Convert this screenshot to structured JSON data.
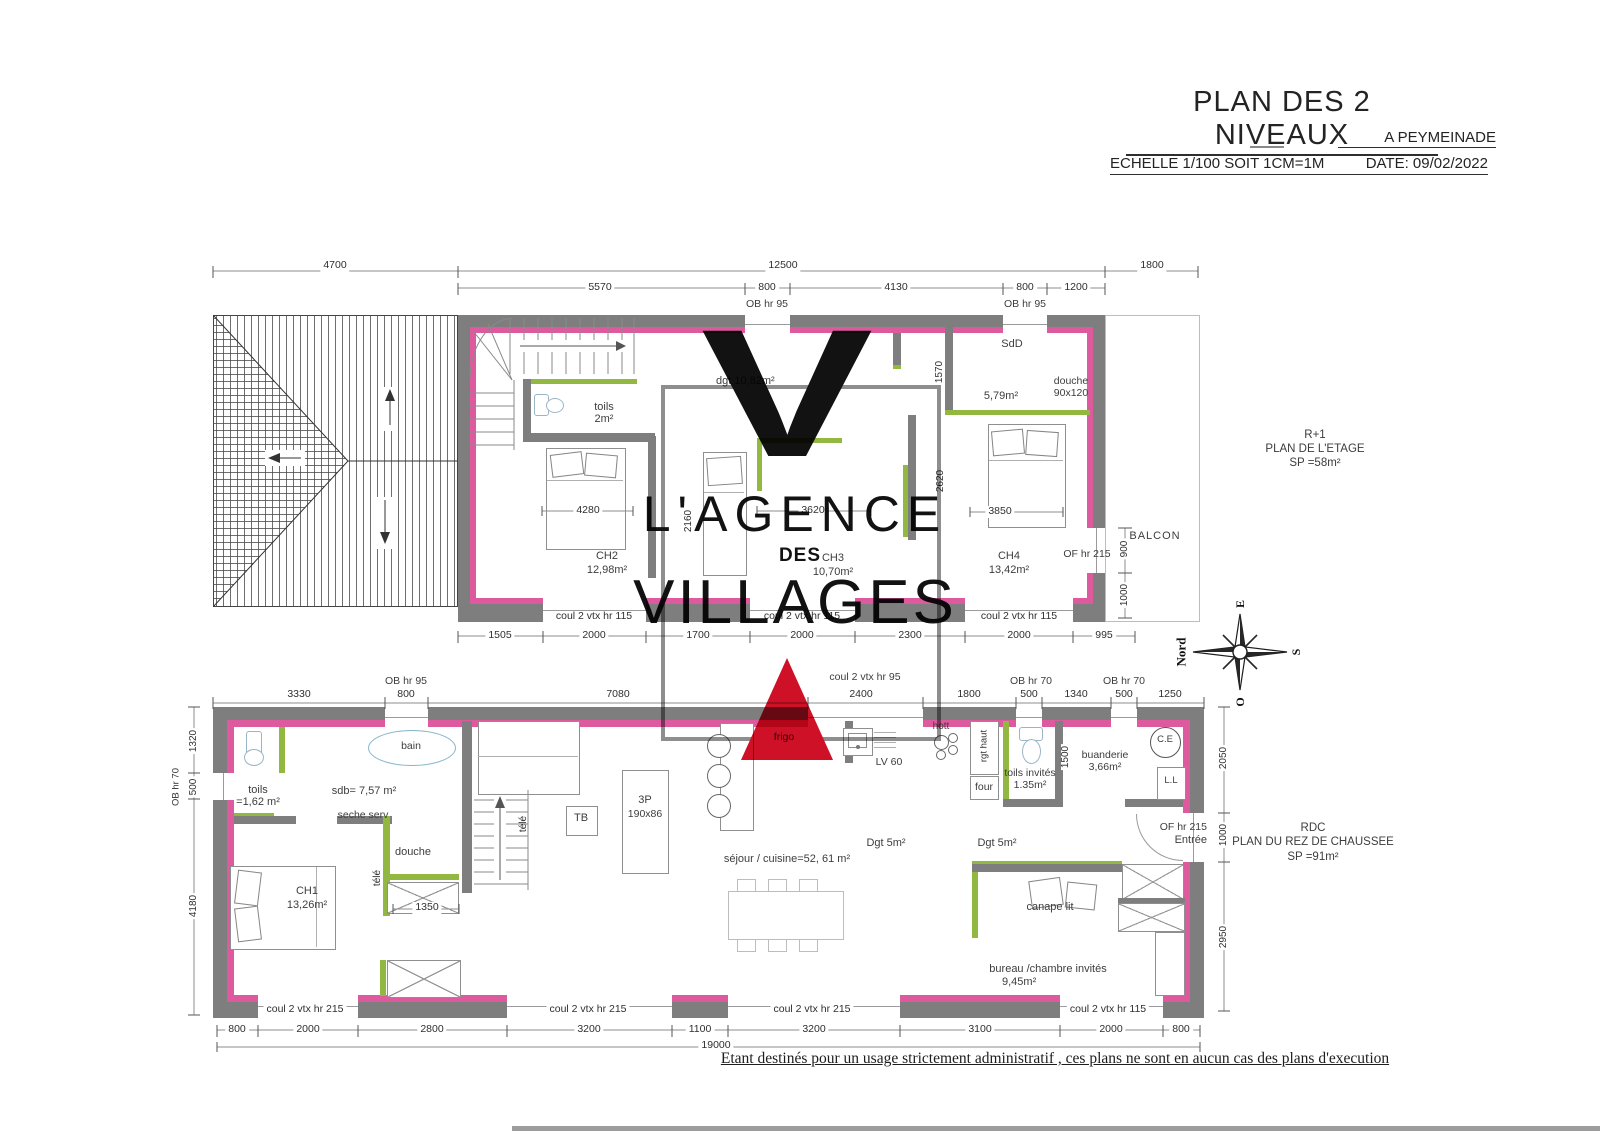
{
  "colors": {
    "wall_gray": "#7e7e7e",
    "wall_pink": "#de5a9e",
    "wall_green": "#93b841",
    "logo_red": "#ce1126",
    "logo_frame_gray": "#8e8e8e"
  },
  "title_block": {
    "title": "PLAN DES 2 NIVEAUX",
    "location": "A PEYMEINADE",
    "scale": "ECHELLE 1/100 SOIT 1CM=1M",
    "date": "DATE: 09/02/2022"
  },
  "disclaimer": "Etant destinés pour un usage strictement administratif , ces plans ne sont en aucun cas des plans d'execution",
  "watermark": {
    "v": "V",
    "l1": "L'AGENCE",
    "l2": "DES",
    "l3": "VILLAGES"
  },
  "compass": {
    "north": "Nord",
    "east": "E",
    "south": "S",
    "west": "O"
  },
  "upper": {
    "title": {
      "l1": "R+1",
      "l2": "PLAN DE L'ETAGE",
      "l3": "SP =58m²"
    },
    "dims_row1": [
      "4700",
      "12500",
      "1800"
    ],
    "dims_row2": [
      "5570",
      "800",
      "4130",
      "800",
      "1200"
    ],
    "ob_labels": [
      "OB hr 95",
      "OB hr 95"
    ],
    "window_labels": [
      "coul 2 vtx hr 115",
      "coul 2 vtx hr 115",
      "coul 2 vtx hr 115"
    ],
    "dims_bottom": [
      "1505",
      "2000",
      "1700",
      "2000",
      "2300",
      "2000",
      "995"
    ],
    "dims_inner": {
      "ch2_w": "4280",
      "ch3_w": "3620",
      "ch4_w": "3850",
      "sdd_h": "1570",
      "ch3_h": "2620",
      "ch2_h": "2160",
      "balc1": "900",
      "balc2": "1000"
    },
    "rooms": {
      "toils": {
        "name": "toils",
        "area": "2m²"
      },
      "ch2": {
        "name": "CH2",
        "area": "12,98m²"
      },
      "dgt": {
        "name": "dgt 10,82m²"
      },
      "ch3": {
        "name": "CH3",
        "area": "10,70m²"
      },
      "sdd": {
        "name": "SdD",
        "area": "5,79m²",
        "shower": "douche",
        "shower_size": "90x120"
      },
      "ch4": {
        "name": "CH4",
        "area": "13,42m²"
      },
      "balcony": "BALCON",
      "of215": "OF hr 215"
    }
  },
  "lower": {
    "title": {
      "l1": "RDC",
      "l2": "PLAN DU REZ DE CHAUSSEE",
      "l3": "SP =91m²"
    },
    "dims_top": [
      "3330",
      "800",
      "7080",
      "2400",
      "1800",
      "500",
      "1340",
      "500",
      "1250"
    ],
    "top_labels": {
      "ob95": "OB hr 95",
      "coul95": "coul 2 vtx hr 95",
      "ob70a": "OB hr 70",
      "ob70b": "OB hr 70"
    },
    "dims_left": [
      "1320",
      "500",
      "4180"
    ],
    "left_ob": "OB hr 70",
    "dims_right": [
      "2050",
      "1000",
      "2950"
    ],
    "dims_bottom": [
      "800",
      "2000",
      "2800",
      "3200",
      "1100",
      "3200",
      "3100",
      "2000",
      "800"
    ],
    "dims_total": "19000",
    "window_labels": [
      "coul 2 vtx hr 215",
      "coul 2 vtx hr 215",
      "coul 2 vtx hr 215",
      "coul 2 vtx hr 115"
    ],
    "dims_inner": {
      "douche_w": "1350",
      "buanderie_h": "1500"
    },
    "rooms": {
      "toils": {
        "name": "toils",
        "area": "=1,62 m²"
      },
      "sdb": {
        "name": "sdb= 7,57 m²",
        "bain": "bain",
        "seche": "seche serv",
        "douche": "douche",
        "tele_a": "télé",
        "tele_b": "télé"
      },
      "ch1": {
        "name": "CH1",
        "area": "13,26m²"
      },
      "sejour": {
        "name": "séjour / cuisine=52, 61 m²",
        "tb": "TB",
        "p3": "3P",
        "p3_size": "190x86"
      },
      "kitchen": {
        "frigo": "frigo",
        "hotte": "hott",
        "lv": "LV 60",
        "rgt": "rgt haut",
        "four": "four"
      },
      "toils_invites": {
        "name": "toils invités",
        "area": "1.35m²"
      },
      "buanderie": {
        "name": "buanderie",
        "area": "3,66m²",
        "ce": "C.E",
        "ll": "L.L"
      },
      "entree": {
        "of": "OF hr 215",
        "name": "Entrée"
      },
      "dgt_a": "Dgt 5m²",
      "dgt_b": "Dgt 5m²",
      "bureau": {
        "canape": "canape lit",
        "name": "bureau /chambre invités",
        "area": "9,45m²"
      }
    }
  }
}
